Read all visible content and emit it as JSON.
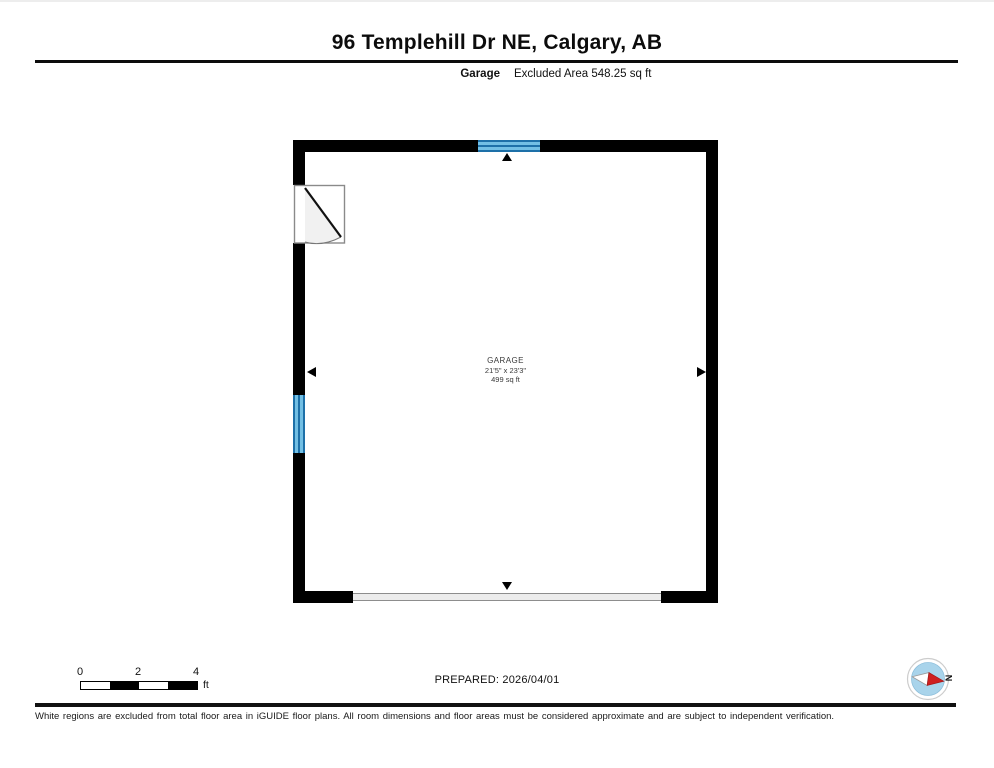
{
  "header": {
    "title": "96 Templehill Dr NE, Calgary, AB",
    "floor_label": "Garage",
    "excluded_area": "Excluded Area 548.25 sq ft"
  },
  "floorplan": {
    "room": {
      "name": "GARAGE",
      "dimensions": "21'5\" x 23'3\"",
      "area": "499 sq ft"
    },
    "colors": {
      "wall": "#000000",
      "window_fill": "#72bfe4",
      "window_line": "#1d70a8",
      "garage_door_fill": "#ececec",
      "garage_door_border": "#8d8d8d",
      "compass_blue": "#a9d4eb",
      "compass_red": "#cf1f1f"
    }
  },
  "scale_bar": {
    "ticks": [
      "0",
      "2",
      "4"
    ],
    "unit": "ft"
  },
  "footer": {
    "prepared": "PREPARED: 2026/04/01",
    "compass_label": "N",
    "disclaimer": "White regions are excluded from total floor area in iGUIDE floor plans. All room dimensions and floor areas must be considered approximate and are subject to independent verification."
  }
}
